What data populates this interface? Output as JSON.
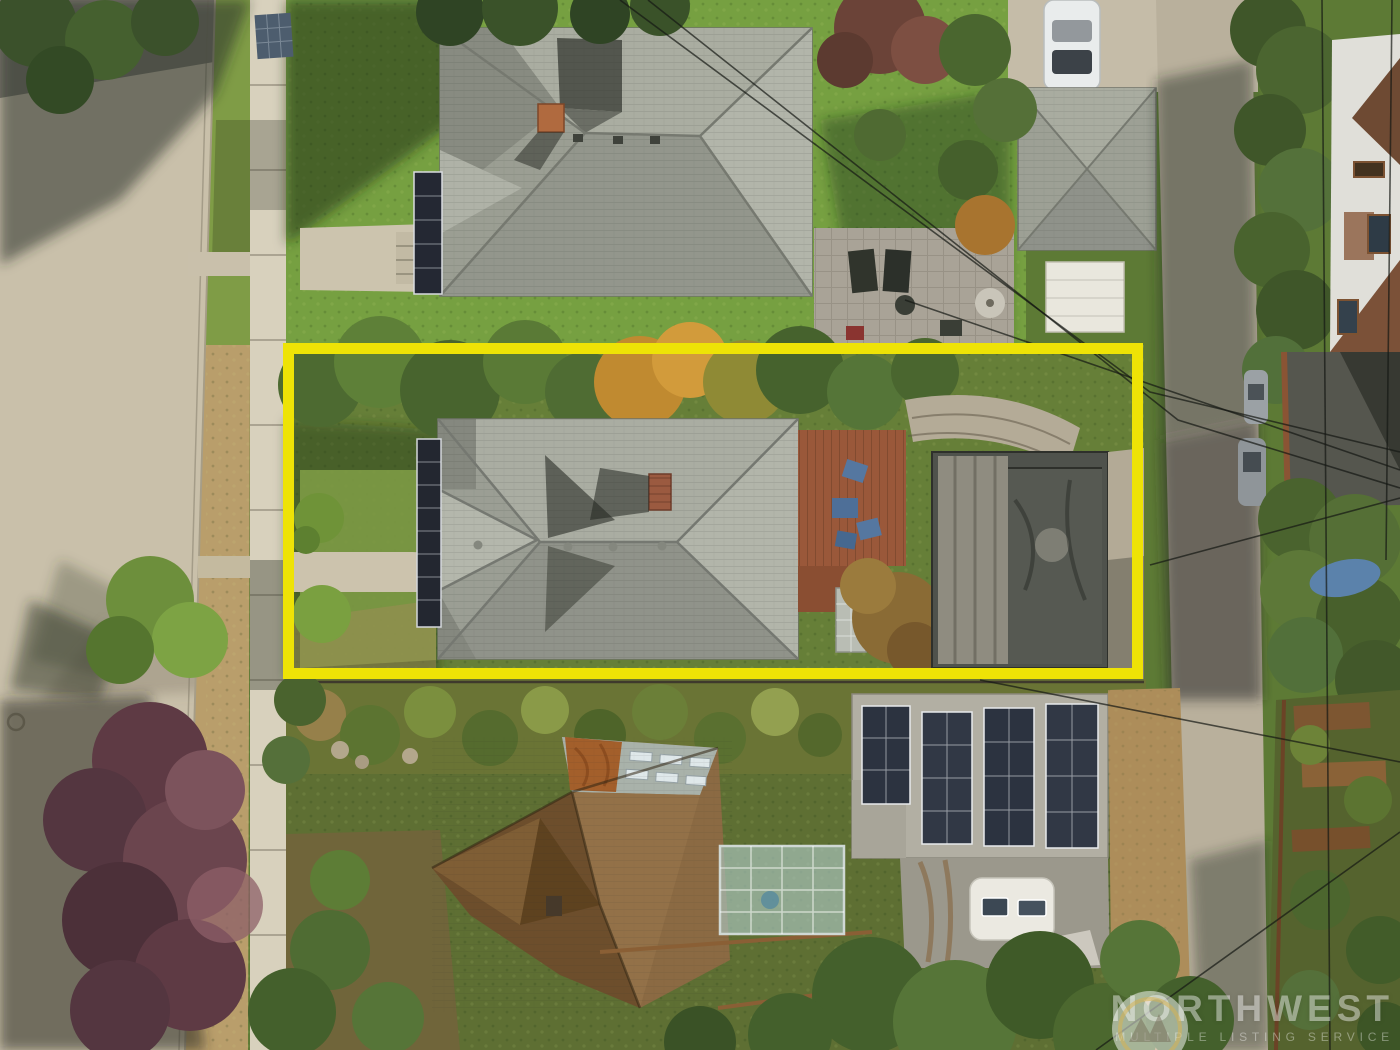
{
  "scene": {
    "type": "aerial-drone-photo",
    "subject": "residential lot highlighted with yellow boundary"
  },
  "watermark": {
    "brand": "NORTHWEST",
    "tagline": "MULTIPLE LISTING SERVICE",
    "logo_icon": "nwmls-logo"
  },
  "colors": {
    "property_boundary": "#eee306",
    "watermark_text": "rgba(255,255,255,0.44)"
  }
}
